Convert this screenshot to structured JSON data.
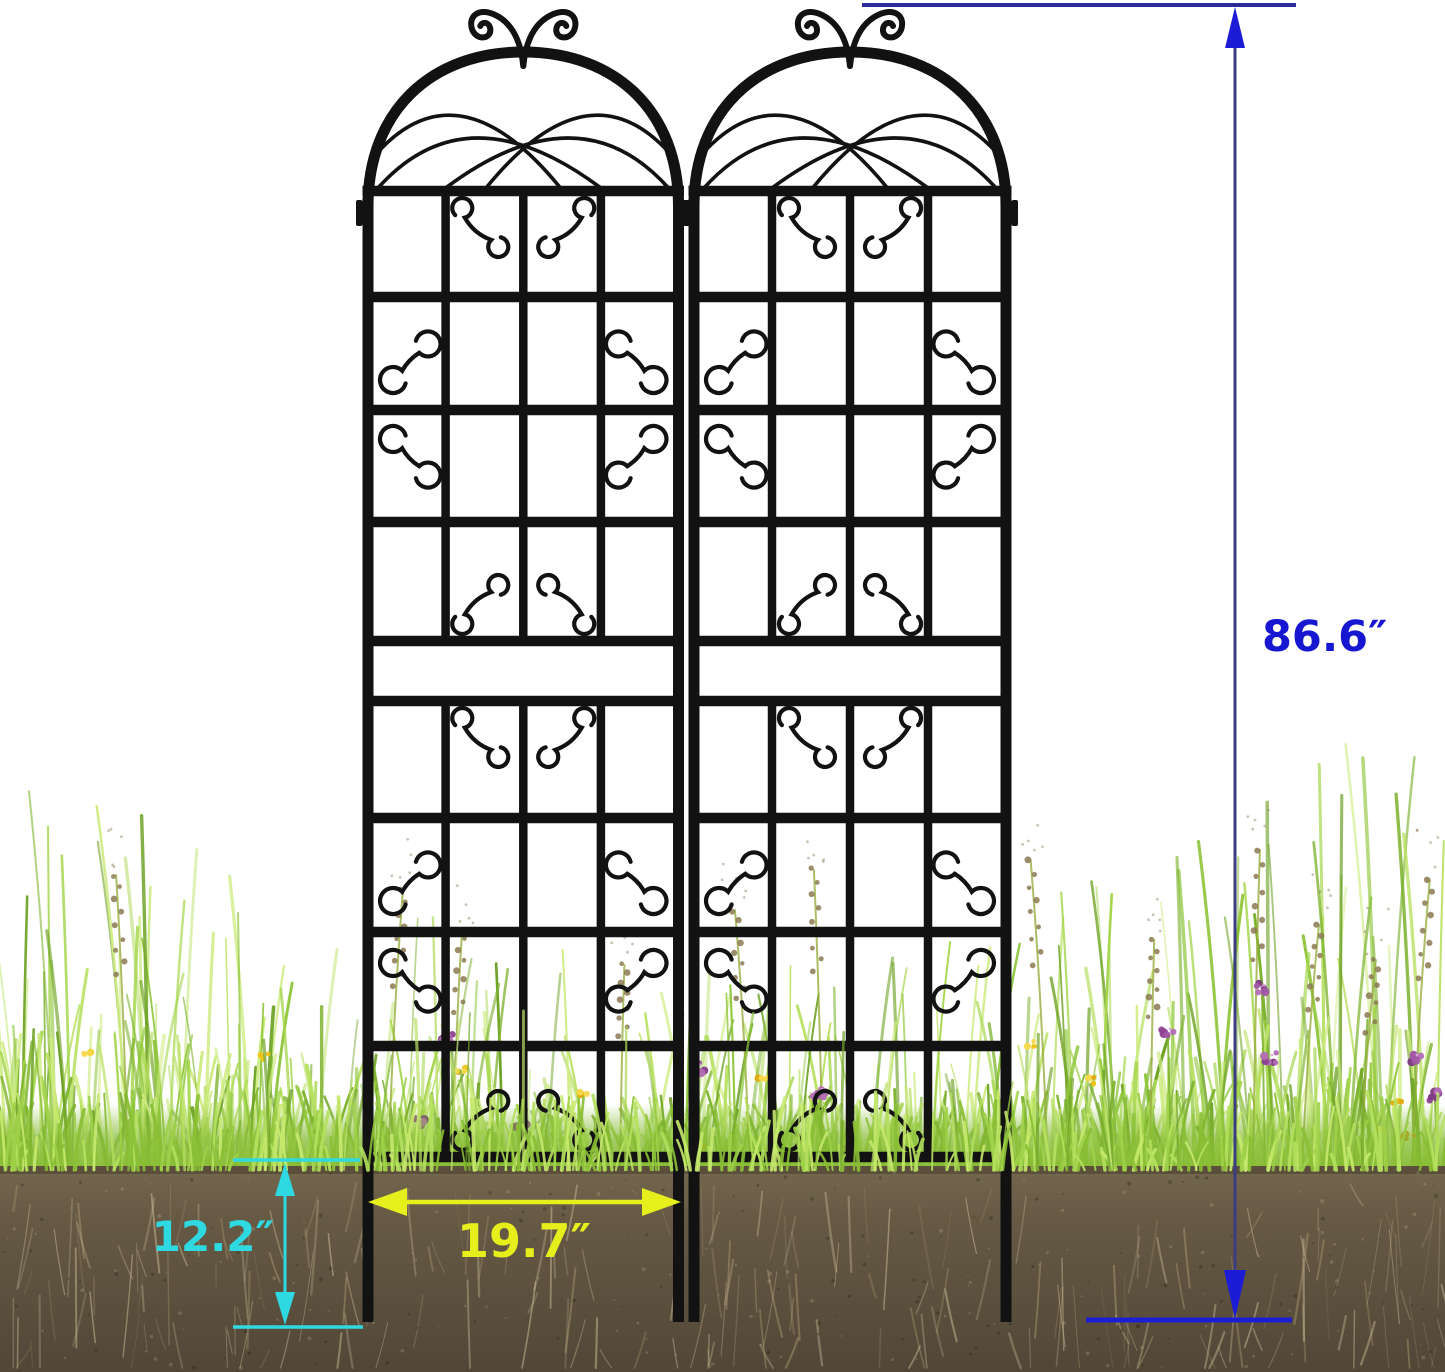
{
  "annotations": {
    "height": {
      "label": "86.6″",
      "color": "#1717d2"
    },
    "depth": {
      "label": "12.2″",
      "color": "#2ed9e2"
    },
    "width": {
      "label": "19.7″",
      "color": "#e6ef1b"
    }
  },
  "colors": {
    "background": "#ffffff",
    "trellis": "#121212",
    "height_arrow": "#1c1cd6",
    "height_shaft": "#3c3c80",
    "height_rule_top": "#2a2a99",
    "height_rule_bottom": "#1d1dd4",
    "depth_arrow": "#2ed9e2",
    "width_arrow": "#e6ef1b",
    "grass_palette": [
      "#8fc63c",
      "#a5d64d",
      "#7cb22e",
      "#b9e164",
      "#6fa327",
      "#cdeb7f"
    ],
    "grass_fringe": [
      "#9ed049",
      "#b4e05e",
      "#8abf35",
      "#c6e96e"
    ],
    "lawn_base": "#86bb33",
    "soil_top": "#75684f",
    "soil_mid": "#665a45",
    "soil_bottom": "#524737",
    "soil_shadow": "#3e3426",
    "root_light": "#cdbe9a",
    "root_mid": "#aa9670",
    "seed": "#8b7a52",
    "stalk": "#99ad3f",
    "flower_purple": [
      "#a257a5",
      "#8d4190",
      "#b26cb5",
      "#7d3982"
    ],
    "flower_yellow": [
      "#f0c419",
      "#e2a810",
      "#f6d84a"
    ],
    "flower_orange": "#df8a1a"
  },
  "scene": {
    "objects": [
      "garden trellis panel (left)",
      "garden trellis panel (right)",
      "grass with wildflowers",
      "soil cross-section"
    ]
  }
}
